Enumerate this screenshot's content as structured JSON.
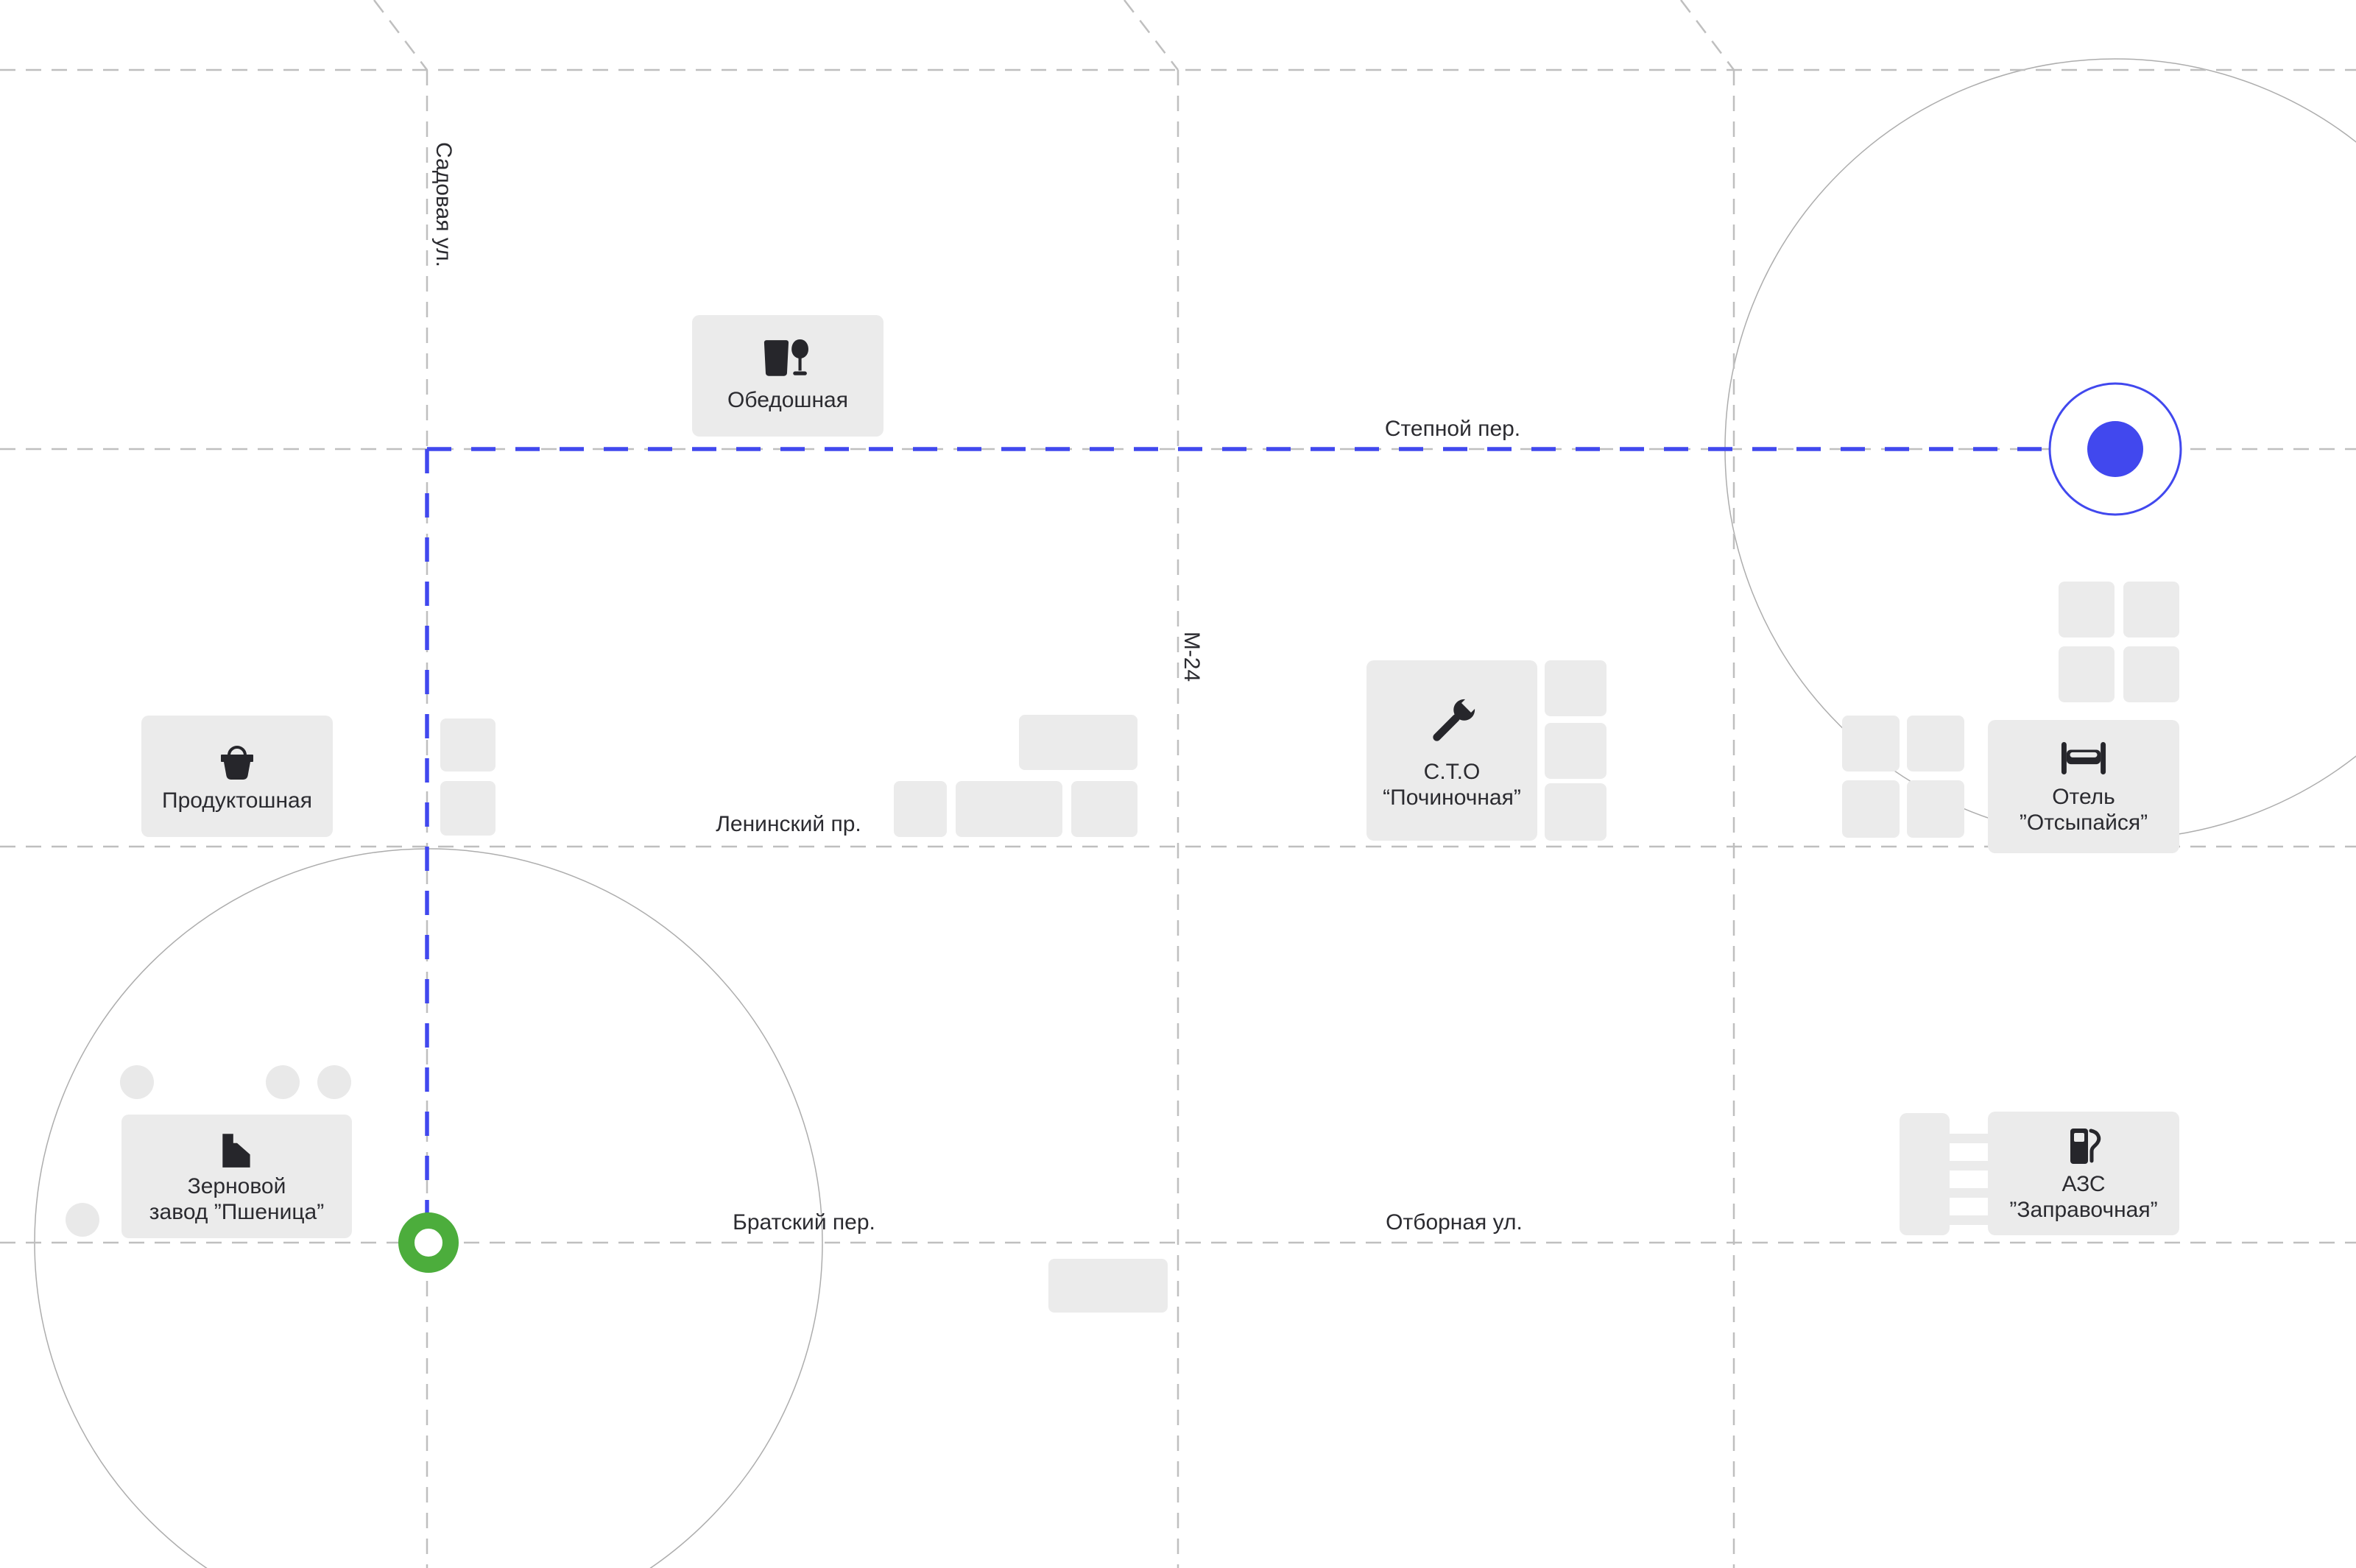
{
  "map": {
    "kind": "city-street-map",
    "background": "#ffffff"
  },
  "streets": [
    {
      "name": "Садовая ул.",
      "orientation": "vertical"
    },
    {
      "name": "М-24",
      "orientation": "vertical"
    },
    {
      "name": "Степной пер.",
      "orientation": "horizontal"
    },
    {
      "name": "Ленинский пр.",
      "orientation": "horizontal"
    },
    {
      "name": "Братский пер.",
      "orientation": "horizontal"
    },
    {
      "name": "Отборная ул.",
      "orientation": "horizontal"
    }
  ],
  "pois": [
    {
      "name": "Обедошная",
      "icon": "restaurant-icon"
    },
    {
      "name": "Продуктошная",
      "icon": "basket-icon"
    },
    {
      "name": "С.Т.О\n“Починочная”",
      "icon": "wrench-icon"
    },
    {
      "name": "Отель\n”Отсыпайся”",
      "icon": "bed-icon"
    },
    {
      "name": "Зерновой\nзавод ”Пшеница”",
      "icon": "factory-icon"
    },
    {
      "name": "АЗС\n”Заправочная”",
      "icon": "fuel-icon"
    }
  ],
  "route": {
    "color": "#4148ee",
    "style": "dashed"
  },
  "markers": {
    "start": {
      "shape": "ring",
      "color": "#4cad3c"
    },
    "destination": {
      "shape": "dot-in-ring",
      "color": "#4148ee"
    }
  },
  "colors": {
    "road": "#bfbfbf",
    "building": "#ebebeb",
    "text": "#2b2b30",
    "range_circle": "#adadad"
  }
}
